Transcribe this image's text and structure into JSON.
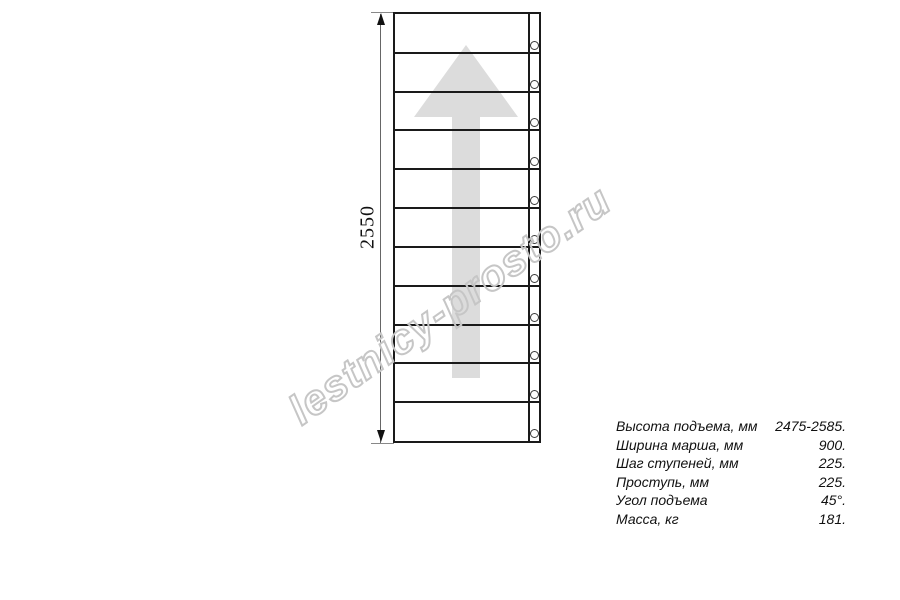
{
  "watermark": {
    "text": "lestnicy-prosto.ru",
    "outline_color": "#c6c6c6"
  },
  "drawing": {
    "dimension_label": "2550",
    "steps_count": 11,
    "bolt_count": 11,
    "arrow_color": "#dcdcdc",
    "line_color": "#1a1a1a"
  },
  "specs": {
    "rows": [
      {
        "label": "Высота подъема, мм",
        "value": "2475-2585."
      },
      {
        "label": "Ширина марша, мм",
        "value": "900."
      },
      {
        "label": "Шаг ступеней, мм",
        "value": "225."
      },
      {
        "label": "Проступь, мм",
        "value": "225."
      },
      {
        "label": "Угол подъема",
        "value": "45°."
      },
      {
        "label": "Масса, кг",
        "value": "181."
      }
    ]
  }
}
